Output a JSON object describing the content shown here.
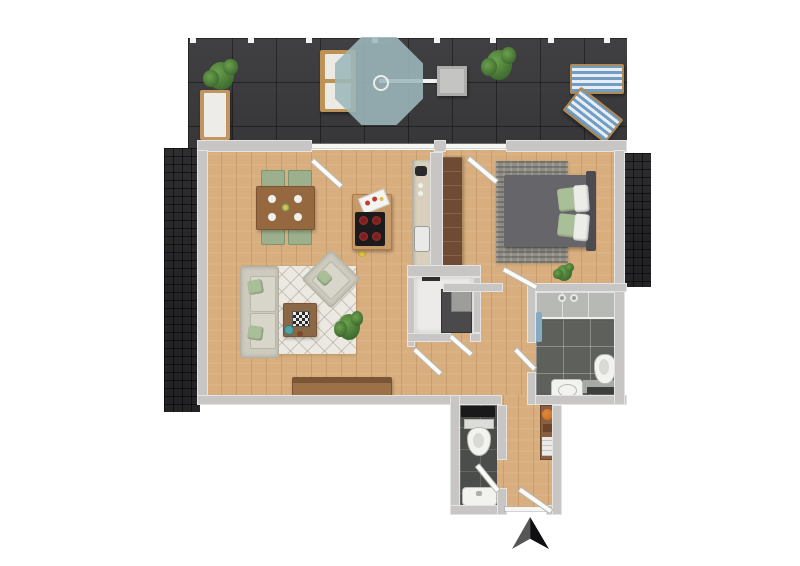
{
  "title": "apartment-floor-plan",
  "compass": {
    "symbol": "north-arrow",
    "direction": "up"
  },
  "palette": {
    "bg": "#ffffff",
    "wall": "#c7c6c4",
    "floorWood": "#d8ae7e",
    "terraceTile": "#3a3a3c",
    "roofShingle": "#232325",
    "rugLiving": "#ebe9e2",
    "rugBedroom": "#8f8d85",
    "sofa": "#cdcabe",
    "pillowGreen": "#a9bf97",
    "woodFurniture": "#a3744a",
    "woodDark": "#6e4b32",
    "bathFloor": "#5d605b",
    "showerFloor": "#b7bab4",
    "wcFloor": "#4b4d4a",
    "storageFloor": "#ecebe9",
    "appliance": "#4a4a4d",
    "counter": "#d8cfbc",
    "cooktop": "#1b1b1d",
    "burnerRed": "#c23b33",
    "umbrellaTeal": "#9eb8bc",
    "loungerBlue": "#6f9dc4",
    "plantGreen": "#3d6b2e",
    "plantLight": "#6ca04e",
    "towelBlue": "#84aac4",
    "ballOrange": "#c2691f",
    "bedGray": "#66666a",
    "headboardGray": "#4c4c50",
    "arrowBlack": "#0f0f11",
    "arrowGray": "#565656"
  },
  "rooms": [
    {
      "name": "terrace"
    },
    {
      "name": "living-room"
    },
    {
      "name": "dining-area"
    },
    {
      "name": "kitchen"
    },
    {
      "name": "bedroom"
    },
    {
      "name": "bathroom"
    },
    {
      "name": "storage-room"
    },
    {
      "name": "hallway"
    },
    {
      "name": "guest-wc"
    },
    {
      "name": "entry"
    }
  ],
  "furniture": {
    "terrace": [
      "plant",
      "garden-bench",
      "lounge-chairs",
      "cantilever-umbrella",
      "side-table",
      "plant",
      "sun-lounger",
      "sun-lounger"
    ],
    "living_room": [
      "dining-table",
      "four-chairs",
      "sofa",
      "armchair",
      "coffee-table",
      "chessboard",
      "rug",
      "plant",
      "sideboard"
    ],
    "kitchen": [
      "counter-with-sink",
      "island-with-cooktop",
      "cutting-board"
    ],
    "bedroom": [
      "double-bed",
      "pillows",
      "rug",
      "wardrobe",
      "plant"
    ],
    "bathroom": [
      "walk-in-shower",
      "toilet",
      "washbasin",
      "towel"
    ],
    "storage_room": [
      "washer",
      "dryer"
    ],
    "guest_wc": [
      "toilet",
      "washbasin",
      "shelf"
    ],
    "entry": [
      "hall-cabinet",
      "decor-ball"
    ]
  }
}
